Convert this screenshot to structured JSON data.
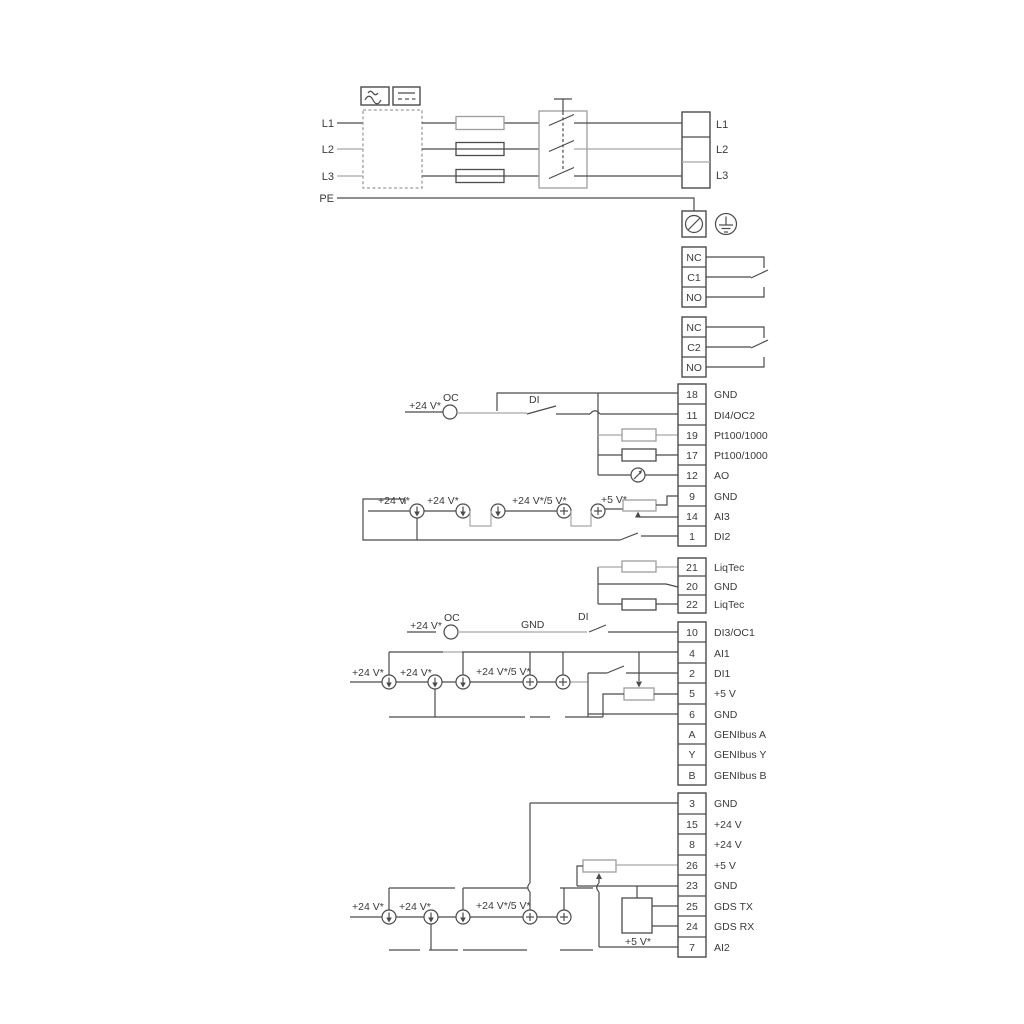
{
  "power": {
    "inputs": [
      "L1",
      "L2",
      "L3",
      "PE"
    ],
    "outputs": [
      "L1",
      "L2",
      "L3"
    ]
  },
  "relays": {
    "relay1": [
      "NC",
      "C1",
      "NO"
    ],
    "relay2": [
      "NC",
      "C2",
      "NO"
    ]
  },
  "strips": {
    "io1": [
      {
        "id": "18",
        "label": "GND"
      },
      {
        "id": "11",
        "label": "DI4/OC2"
      },
      {
        "id": "19",
        "label": "Pt100/1000"
      },
      {
        "id": "17",
        "label": "Pt100/1000"
      },
      {
        "id": "12",
        "label": "AO"
      },
      {
        "id": "9",
        "label": "GND"
      },
      {
        "id": "14",
        "label": "AI3"
      },
      {
        "id": "1",
        "label": "DI2"
      }
    ],
    "liqtec": [
      {
        "id": "21",
        "label": "LiqTec"
      },
      {
        "id": "20",
        "label": "GND"
      },
      {
        "id": "22",
        "label": "LiqTec"
      }
    ],
    "io2": [
      {
        "id": "10",
        "label": "DI3/OC1"
      },
      {
        "id": "4",
        "label": "AI1"
      },
      {
        "id": "2",
        "label": "DI1"
      },
      {
        "id": "5",
        "label": "+5 V"
      },
      {
        "id": "6",
        "label": "GND"
      },
      {
        "id": "A",
        "label": "GENIbus A"
      },
      {
        "id": "Y",
        "label": "GENIbus Y"
      },
      {
        "id": "B",
        "label": "GENIbus B"
      }
    ],
    "io3": [
      {
        "id": "3",
        "label": "GND"
      },
      {
        "id": "15",
        "label": "+24 V"
      },
      {
        "id": "8",
        "label": "+24 V"
      },
      {
        "id": "26",
        "label": "+5 V"
      },
      {
        "id": "23",
        "label": "GND"
      },
      {
        "id": "25",
        "label": "GDS TX"
      },
      {
        "id": "24",
        "label": "GDS RX"
      },
      {
        "id": "7",
        "label": "AI2"
      }
    ]
  },
  "wire_labels": {
    "di4": {
      "v24": "+24 V*",
      "oc": "OC",
      "di": "DI"
    },
    "ai3": {
      "v24a": "+24 V*",
      "v24b": "+24 V*",
      "v24_5": "+24 V*/5 V*",
      "v5": "+5 V*"
    },
    "di3": {
      "v24": "+24 V*",
      "oc": "OC",
      "gnd": "GND",
      "di": "DI"
    },
    "ai1": {
      "v24a": "+24 V*",
      "v24b": "+24 V*",
      "v24_5": "+24 V*/5 V*"
    },
    "ai2": {
      "v24a": "+24 V*",
      "v24b": "+24 V*",
      "v24_5": "+24 V*/5 V*",
      "v5": "+5 V*"
    }
  },
  "colors": {
    "wire_dark": "#4b4b4b",
    "wire_gray": "#a8a8a8",
    "text": "#3a3a3a",
    "background": "#ffffff"
  },
  "symbols": [
    "ac-wave-icon",
    "dc-line-icon",
    "mains-filter-box",
    "fuse",
    "disconnect-switch",
    "screw-terminal-icon",
    "earth-ground-icon",
    "relay-changeover-contact",
    "sensor-resistor",
    "analog-output-meter-icon",
    "current-source-down-icon",
    "current-source-plus-icon",
    "potentiometer",
    "gds-sensor-box",
    "digital-input-switch"
  ]
}
